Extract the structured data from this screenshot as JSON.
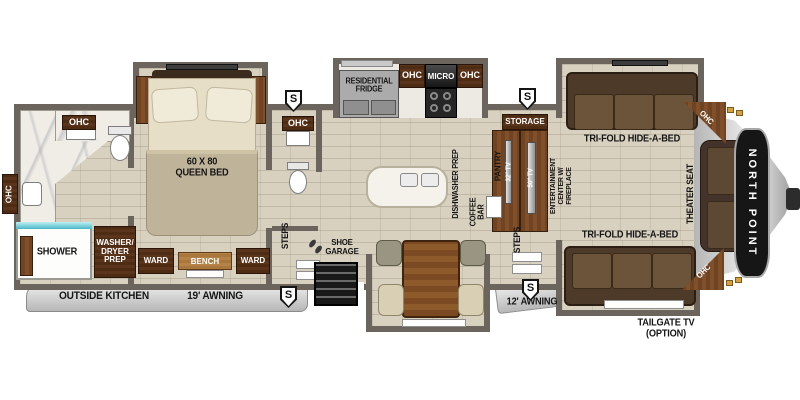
{
  "floorplan": {
    "brand": "NORTH POINT",
    "labels": {
      "ohc": "OHC",
      "queen_bed": "60 X 80\nQUEEN BED",
      "shower": "SHOWER",
      "washer_dryer": "WASHER/\nDRYER\nPREP",
      "ward": "WARD",
      "bench": "BENCH",
      "steps": "STEPS",
      "shoe_garage": "SHOE\nGARAGE",
      "outside_kitchen": "OUTSIDE KITCHEN",
      "awning_19": "19' AWNING",
      "awning_12": "12' AWNING",
      "residential_fridge": "RESIDENTIAL\nFRIDGE",
      "micro": "MICRO",
      "dishwasher_prep": "DISHWASHER PREP",
      "coffee_bar": "COFFEE\nBAR",
      "pantry": "PANTRY",
      "tv_32": "32\" TV",
      "tv_50": "50\" TV",
      "storage": "STORAGE",
      "entertainment": "ENTERTAINMENT\nCENTER W/\nFIREPLACE",
      "trifold": "TRI-FOLD HIDE-A-BED",
      "theater_seat": "THEATER SEAT",
      "tailgate_tv": "TAILGATE TV\n(OPTION)",
      "speaker": "S"
    },
    "colors": {
      "wall": "#6b655e",
      "floor": "#d8d1c0",
      "wood": "#7a4c26",
      "wood_dark": "#4e2c14",
      "sofa": "#4e3a28",
      "cushion": "#6b543a",
      "marble": "#efede6",
      "shower_teal": "#49b8c6",
      "awning_rail": "#c9c9c9",
      "bed_blanket": "#bfb49a",
      "bed_sheet": "#e6dec6",
      "front_cap_panel": "#161616"
    }
  }
}
